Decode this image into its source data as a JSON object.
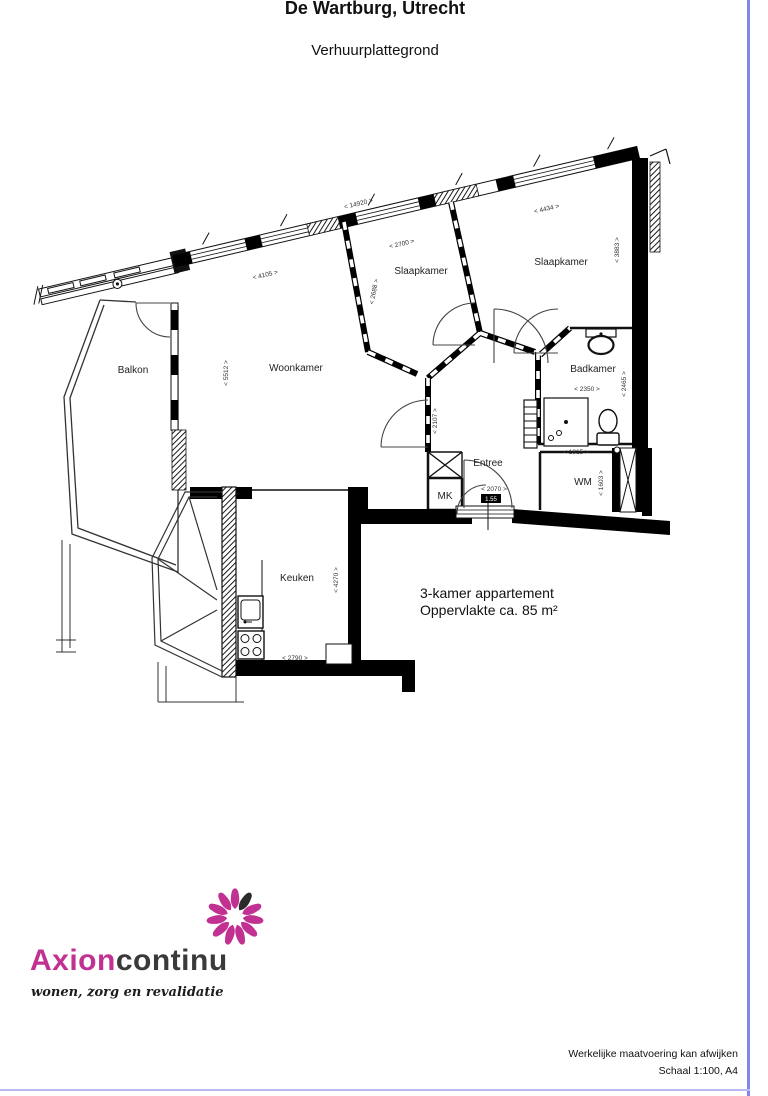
{
  "page": {
    "title": "De Wartburg, Utrecht",
    "subtitle": "Verhuurplattegrond",
    "description_line1": "3-kamer appartement",
    "description_line2": "Oppervlakte ca. 85 m²",
    "footer_line1": "Werkelijke maatvoering kan afwijken",
    "footer_line2": "Schaal 1:100, A4"
  },
  "logo": {
    "brand_primary": "Axion",
    "brand_secondary": "continu",
    "tagline": "wonen, zorg en revalidatie"
  },
  "colors": {
    "logo_accent": "#c03191",
    "logo_text": "#3a3a3a",
    "border_right": "#8285f0",
    "border_bottom": "#b8bbf2"
  },
  "plan": {
    "rooms": [
      "Balkon",
      "Woonkamer",
      "Slaapkamer",
      "Slaapkamer",
      "Badkamer",
      "Entree",
      "WM",
      "MK",
      "Keuken"
    ],
    "dims": [
      "< 14920 >",
      "< 4105 >",
      "< 2700 >",
      "< 4434 >",
      "< 3883 >",
      "< 2688 >",
      "< 5512 >",
      "< 2107 >",
      "< 2350 >",
      "< 2465 >",
      "< 1815 >",
      "< 1603 >",
      "< 2070 >",
      "< 4270 >",
      "< 2790 >"
    ],
    "door_tag": "1.55"
  }
}
